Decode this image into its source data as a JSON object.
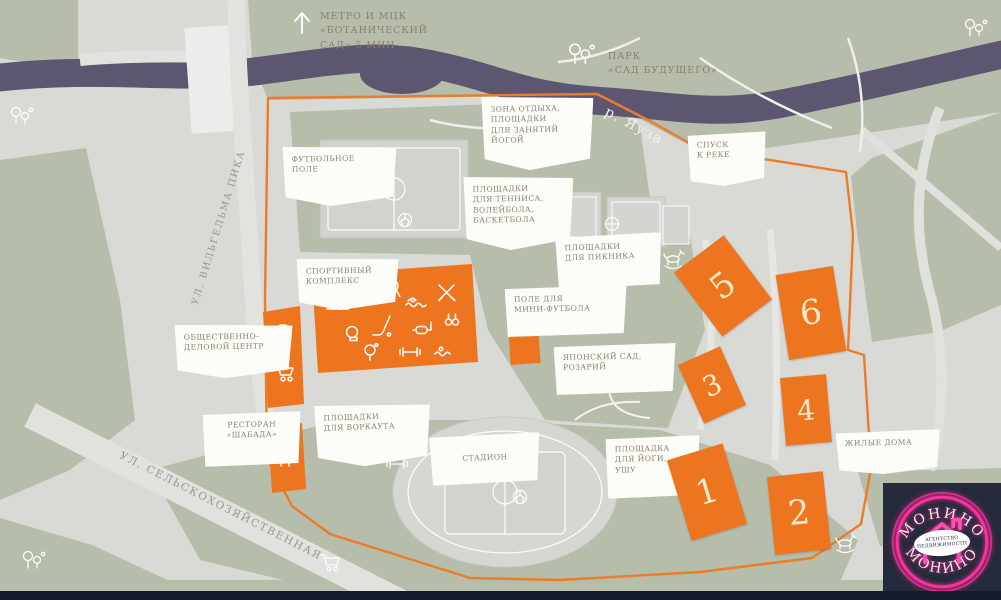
{
  "notes": {
    "metro": "МЕТРО И МЦК\n«БОТАНИЧЕСКИЙ\nСАД» 5 МИН",
    "park": "ПАРК\n«САД БУДУЩЕГО»"
  },
  "river": {
    "label": "р. Яуза"
  },
  "streets": {
    "west": "УЛ. ВИЛЬГЕЛЬМА ПИКА",
    "south": "УЛ. СЕЛЬСКОХОЗЯЙСТВЕННАЯ"
  },
  "callouts": {
    "rest_zone": "ЗОНА ОТДЫХА,\nПЛОЩАДКИ\nДЛЯ ЗАНЯТИЙ\nЙОГОЙ",
    "river_descent": "СПУСК\nК РЕКЕ",
    "football_field": "ФУТБОЛЬНОЕ\nПОЛЕ",
    "tennis": "ПЛОЩАДКИ\nДЛЯ ТЕННИСА,\nВОЛЕЙБОЛА,\nБАСКЕТБОЛА",
    "picnic": "ПЛОЩАДКИ\nДЛЯ ПИКНИКА",
    "sport_complex": "СПОРТИВНЫЙ\nКОМПЛЕКС",
    "mini_football": "ПОЛЕ ДЛЯ\nМИНИ-ФУТБОЛА",
    "japanese_garden": "ЯПОНСКИЙ САД,\nРОЗАРИЙ",
    "business_center": "ОБЩЕСТВЕННО-\nДЕЛОВОЙ ЦЕНТР",
    "restaurant": "РЕСТОРАН\n«ШАБАДА»",
    "workout": "ПЛОЩАДКИ\nДЛЯ ВОРКАУТА",
    "stadium": "СТАДИОН",
    "yoga": "ПЛОЩАДКА\nДЛЯ ЙОГИ,\nУШУ",
    "housing": "ЖИЛЫЕ ДОМА"
  },
  "buildings": [
    {
      "number": "1"
    },
    {
      "number": "2"
    },
    {
      "number": "3"
    },
    {
      "number": "4"
    },
    {
      "number": "5"
    },
    {
      "number": "6"
    }
  ],
  "logo": {
    "brand": "МОНИНО",
    "tagline": "АГЕНТСТВО\nНЕДВИЖИМОСТИ"
  },
  "colors": {
    "accent_orange": "#ee7520",
    "park_green": "#b6bdaa",
    "river_purple": "#5c5670",
    "logo_pink": "#ff2f9e",
    "label_text": "#8c7f6d"
  }
}
